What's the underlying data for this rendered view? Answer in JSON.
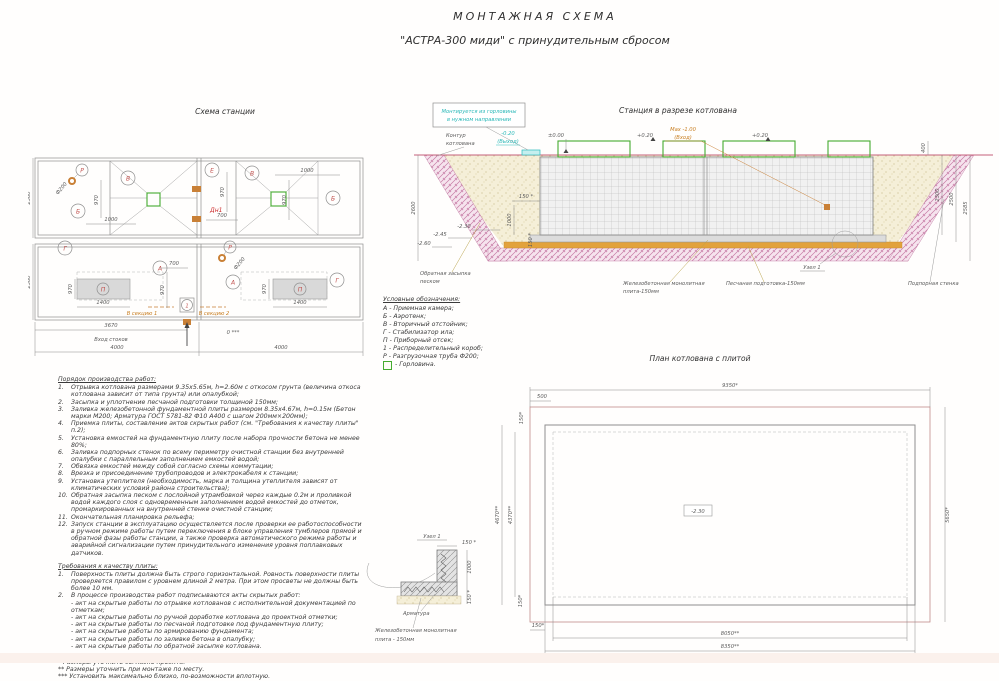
{
  "title": {
    "line1": "МОНТАЖНАЯ СХЕМА",
    "line2": "\"АСТРА-300 миди\" с принудительным сбросом"
  },
  "colors": {
    "accent_green": "#44ab2f",
    "accent_cyan": "#2bbcbc",
    "accent_orange": "#cc8433",
    "hatch_pink": "#c77ba5",
    "label_red": "#c0504d"
  },
  "station_plan": {
    "title": "Схема станции",
    "labels": {
      "a": "А",
      "b": "Б",
      "v": "В",
      "g": "Г",
      "e": "Е",
      "p": "П",
      "r": "Р",
      "one": "1",
      "dn1": "Дн1"
    },
    "dims": {
      "l4000": "4000",
      "l3670": "3670",
      "w2360": "2360",
      "d970": "970",
      "d1000": "1000",
      "d700": "700",
      "d1400": "1400",
      "f200": "Ф200"
    },
    "notes": {
      "inlet": "Вход стоков",
      "zero": "0 ***",
      "sec1": "В секцию 1",
      "sec2": "В секцию 2"
    }
  },
  "legend": {
    "title": "Условные обозначения:",
    "items": [
      "А - Приемная камера;",
      "Б - Аэротенк;",
      "В - Вторичный отстойник;",
      "Г - Стабилизатор ила;",
      "П - Приборный отсек;",
      "1 - Распределительный короб;",
      "Р - Разгрузочная труба Ф200;"
    ],
    "gorlovina": "- Горловина."
  },
  "section": {
    "title": "Станция в разрезе котлована",
    "note": {
      "l1": "Монтируется из горловины",
      "l2": "в нужном направлении"
    },
    "contour": {
      "l1": "Контур",
      "l2": "котлована"
    },
    "elev": {
      "outlet_val": "-0.20",
      "outlet_lbl": "(Выход)",
      "zero": "±0.00",
      "plus_a": "+0.20",
      "inlet_val": "Max -1.00",
      "inlet_lbl": "(Вход)",
      "plus_b": "+0.20"
    },
    "dims": {
      "left2600": "2600",
      "gap150": "150 *",
      "v1000": "1000",
      "slab150": "150 *",
      "r400": "400",
      "r2300": "2300",
      "r2500": "2500",
      "r2585": "2585",
      "e230": "-2.30",
      "e245": "-2.45",
      "e260": "-2.60"
    },
    "labels": {
      "backfill1": "Обратная засыпка",
      "backfill2": "песком",
      "slab1": "Железобетонная монолитная",
      "slab2": "плита-150мм",
      "node": "Узел 1",
      "sand": "Песчаная подготовка-150мм",
      "wall": "Подпорная стенка"
    }
  },
  "pit_plan": {
    "title": "План котлована с плитой",
    "dims": {
      "top": "9350*",
      "offset": "500",
      "l150": "150*",
      "h_outer": "4670**",
      "h_inner": "4370**",
      "right": "5650*",
      "b150": "150*",
      "b_inner": "8050**",
      "b_outer": "8350**",
      "l150b": "150*",
      "elev": "-2.30"
    }
  },
  "node_detail": {
    "title": "Узел 1",
    "dims": {
      "top": "150 *",
      "right": "1000",
      "bottom": "150 *"
    },
    "labels": {
      "rebar": "Арматура",
      "slab1": "Железобетонная монолитная",
      "slab2": "плита - 150мм"
    }
  },
  "work_order": {
    "title": "Порядок производства работ:",
    "steps": [
      "Отрывка котлована размерами 9.35х5.65м, h=2.60м с откосом грунта (величина откоса котлована зависит от типа грунта) или опалубкой;",
      "Засыпка и уплотнение песчаной подготовки толщиной 150мм;",
      "Заливка железобетонной фундаментной плиты размером 8.35х4.67м, h=0.15м (Бетон марки М200; Арматура ГОСТ 5781-82 Ф10 А400 с шагом 200мм×200мм);",
      "Приемка плиты, составление актов скрытых работ (см. \"Требования к качеству плиты\" п.2);",
      "Установка емкостей на фундаментную плиту после набора прочности бетона не менее 80%;",
      "Заливка подпорных стенок по всему периметру очистной станции без внутренней опалубки с параллельным заполнением емкостей водой;",
      "Обвязка емкостей между собой согласно схемы коммутации;",
      "Врезка и присоединение трубопроводов и электрокабеля к станции;",
      "Установка утеплителя (необходимость, марка и толщина утеплителя зависят от климатических условий района строительства);",
      "Обратная засыпка песком с послойной утрамбовкой через каждые 0.2м и проливкой водой каждого слоя с одновременным заполнением водой емкостей до отметок, промаркированных на внутренней стенке очистной станции;",
      "Окончательная планировка рельефа;",
      "Запуск станции в эксплуатацию осуществляется после проверки ее работоспособности в ручном режиме работы путем переключения в блоке управления тумблеров прямой и обратной фазы работы станции, а также проверка автоматического режима работы и аварийной сигнализации путем принудительного изменения уровня поплавковых датчиков."
    ]
  },
  "plate_requirements": {
    "title": "Требования к качеству плиты:",
    "items": [
      "Поверхность плиты должна быть строго горизонтальной. Ровность поверхности плиты проверяется правилом с уровнем длиной 2 метра. При этом просветы не должны быть   более 10 мм.",
      "В процессе производства работ подписываются акты скрытых работ:"
    ],
    "acts": [
      "- акт на скрытые работы по отрывке котлованов с исполнительной документацией по отметкам;",
      "- акт на скрытые работы по ручной доработке котлована до проектной отметки;",
      "- акт на скрытые работы по песчаной подготовке под фундаментную плиту;",
      "- акт на скрытые работы по армированию фундамента;",
      "- акт на скрытые работы по заливке бетона в опалубку;",
      "- акт на скрытые работы по обратной засыпке котлована."
    ]
  },
  "footnotes": [
    "* Размеры уточнить согласно проекта.",
    "** Размеры уточнить при монтаже по месту.",
    "*** Установить максимально близко, по-возможности вплотную."
  ]
}
